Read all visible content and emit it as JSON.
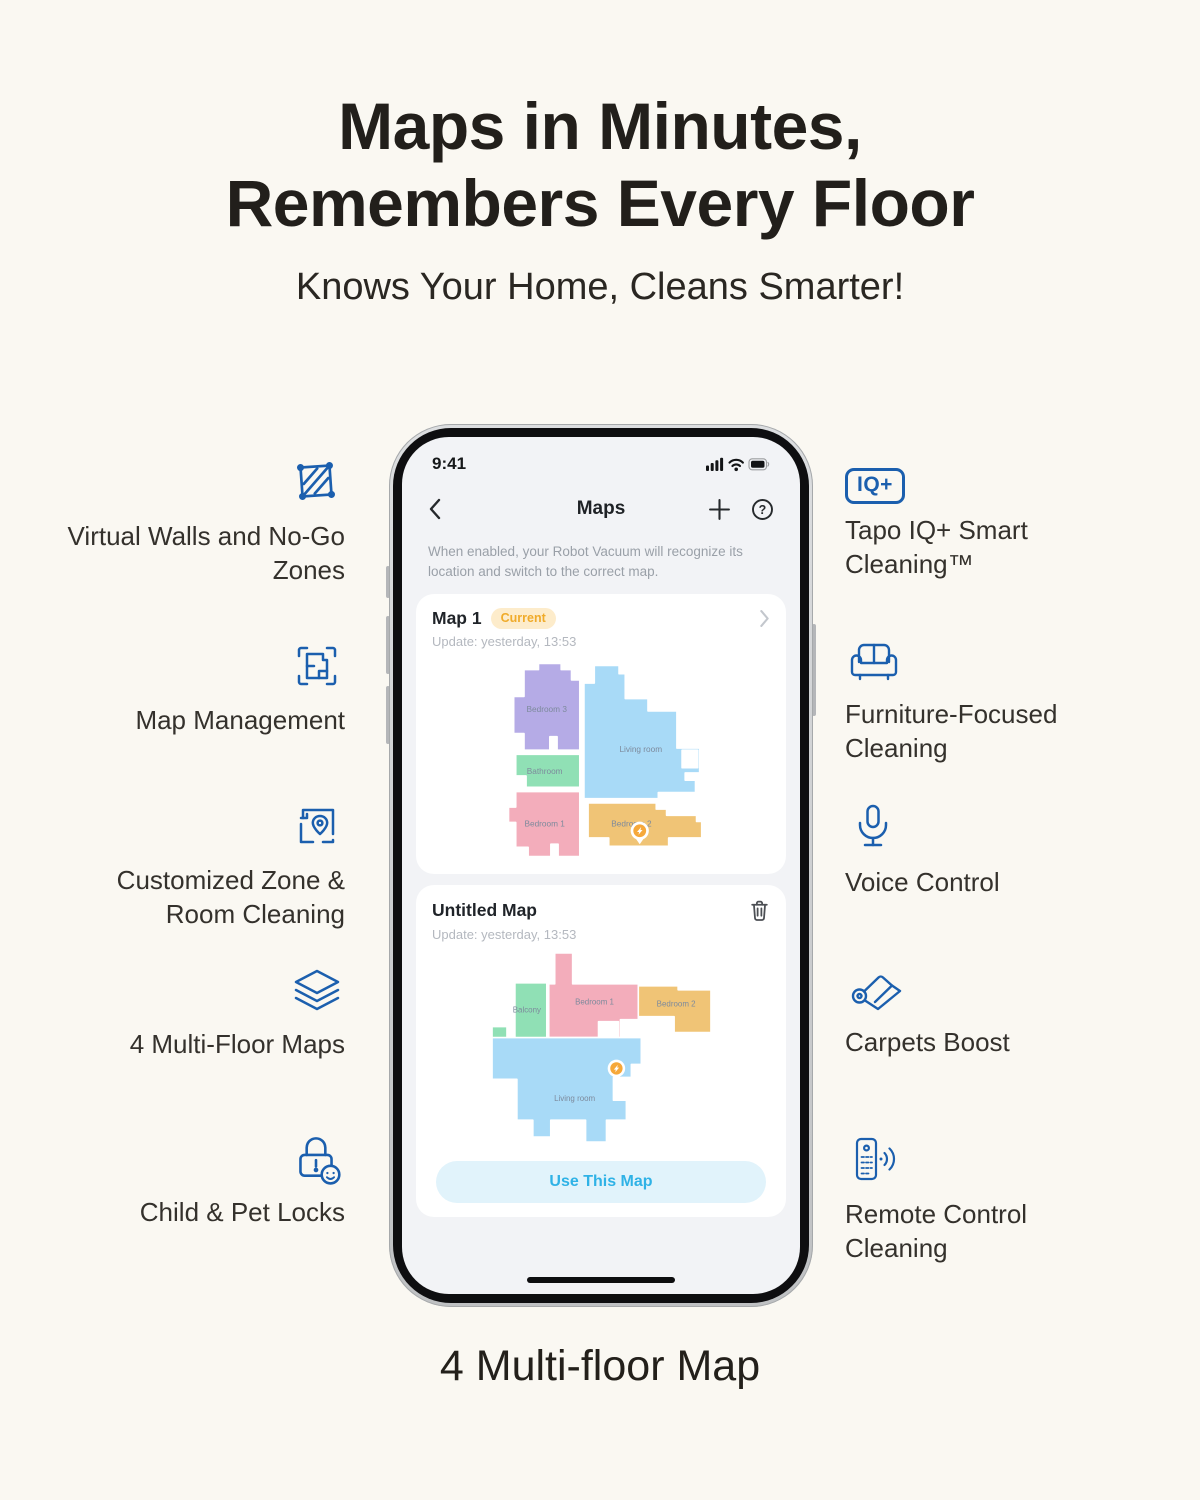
{
  "page": {
    "title_line1": "Maps in Minutes,",
    "title_line2": "Remembers Every Floor",
    "subtitle": "Knows Your Home, Cleans Smarter!",
    "caption": "4 Multi-floor Map"
  },
  "features": {
    "left": [
      {
        "icon": "virtual-walls-icon",
        "label": "Virtual Walls and No-Go Zones"
      },
      {
        "icon": "map-management-icon",
        "label": "Map Management"
      },
      {
        "icon": "zone-room-cleaning-icon",
        "label": "Customized Zone & Room Cleaning"
      },
      {
        "icon": "multi-floor-maps-icon",
        "label": "4 Multi-Floor Maps"
      },
      {
        "icon": "child-pet-locks-icon",
        "label": "Child & Pet Locks"
      }
    ],
    "right": [
      {
        "icon": "iq-plus-icon",
        "icon_text": "IQ+",
        "label": "Tapo IQ+ Smart Cleaning™"
      },
      {
        "icon": "sofa-icon",
        "label": "Furniture-Focused Cleaning"
      },
      {
        "icon": "microphone-icon",
        "label": "Voice Control"
      },
      {
        "icon": "carpet-icon",
        "label": "Carpets Boost"
      },
      {
        "icon": "remote-control-icon",
        "label": "Remote Control Cleaning"
      }
    ]
  },
  "phone": {
    "status_bar": {
      "time": "9:41"
    },
    "nav": {
      "title": "Maps"
    },
    "description": "When enabled, your Robot Vacuum will recognize its location and switch to the correct map.",
    "map_card_1": {
      "title": "Map 1",
      "badge": "Current",
      "update": "Update: yesterday, 13:53",
      "rooms": [
        {
          "name": "Bedroom 3",
          "color": "#b5abe6"
        },
        {
          "name": "Bathroom",
          "color": "#90e0b5"
        },
        {
          "name": "Bedroom 1",
          "color": "#f3adbb"
        },
        {
          "name": "Living room",
          "color": "#a8daf7"
        },
        {
          "name": "Bedroom 2",
          "color": "#f0c476"
        }
      ]
    },
    "map_card_2": {
      "title": "Untitled Map",
      "update": "Update: yesterday, 13:53",
      "rooms": [
        {
          "name": "Balcony",
          "color": "#90e0b5"
        },
        {
          "name": "Bedroom 1",
          "color": "#f3adbb"
        },
        {
          "name": "Bedroom 2",
          "color": "#f0c476"
        },
        {
          "name": "Living room",
          "color": "#a8daf7"
        }
      ],
      "button": "Use This Map"
    }
  },
  "colors": {
    "accent_blue": "#1b5fae",
    "badge_bg": "#fdeccb",
    "badge_text": "#f0ab2a",
    "button_bg": "#e1f3fb",
    "button_text": "#2fb2e6",
    "background": "#faf8f2",
    "marker_orange": "#f6a83a"
  }
}
